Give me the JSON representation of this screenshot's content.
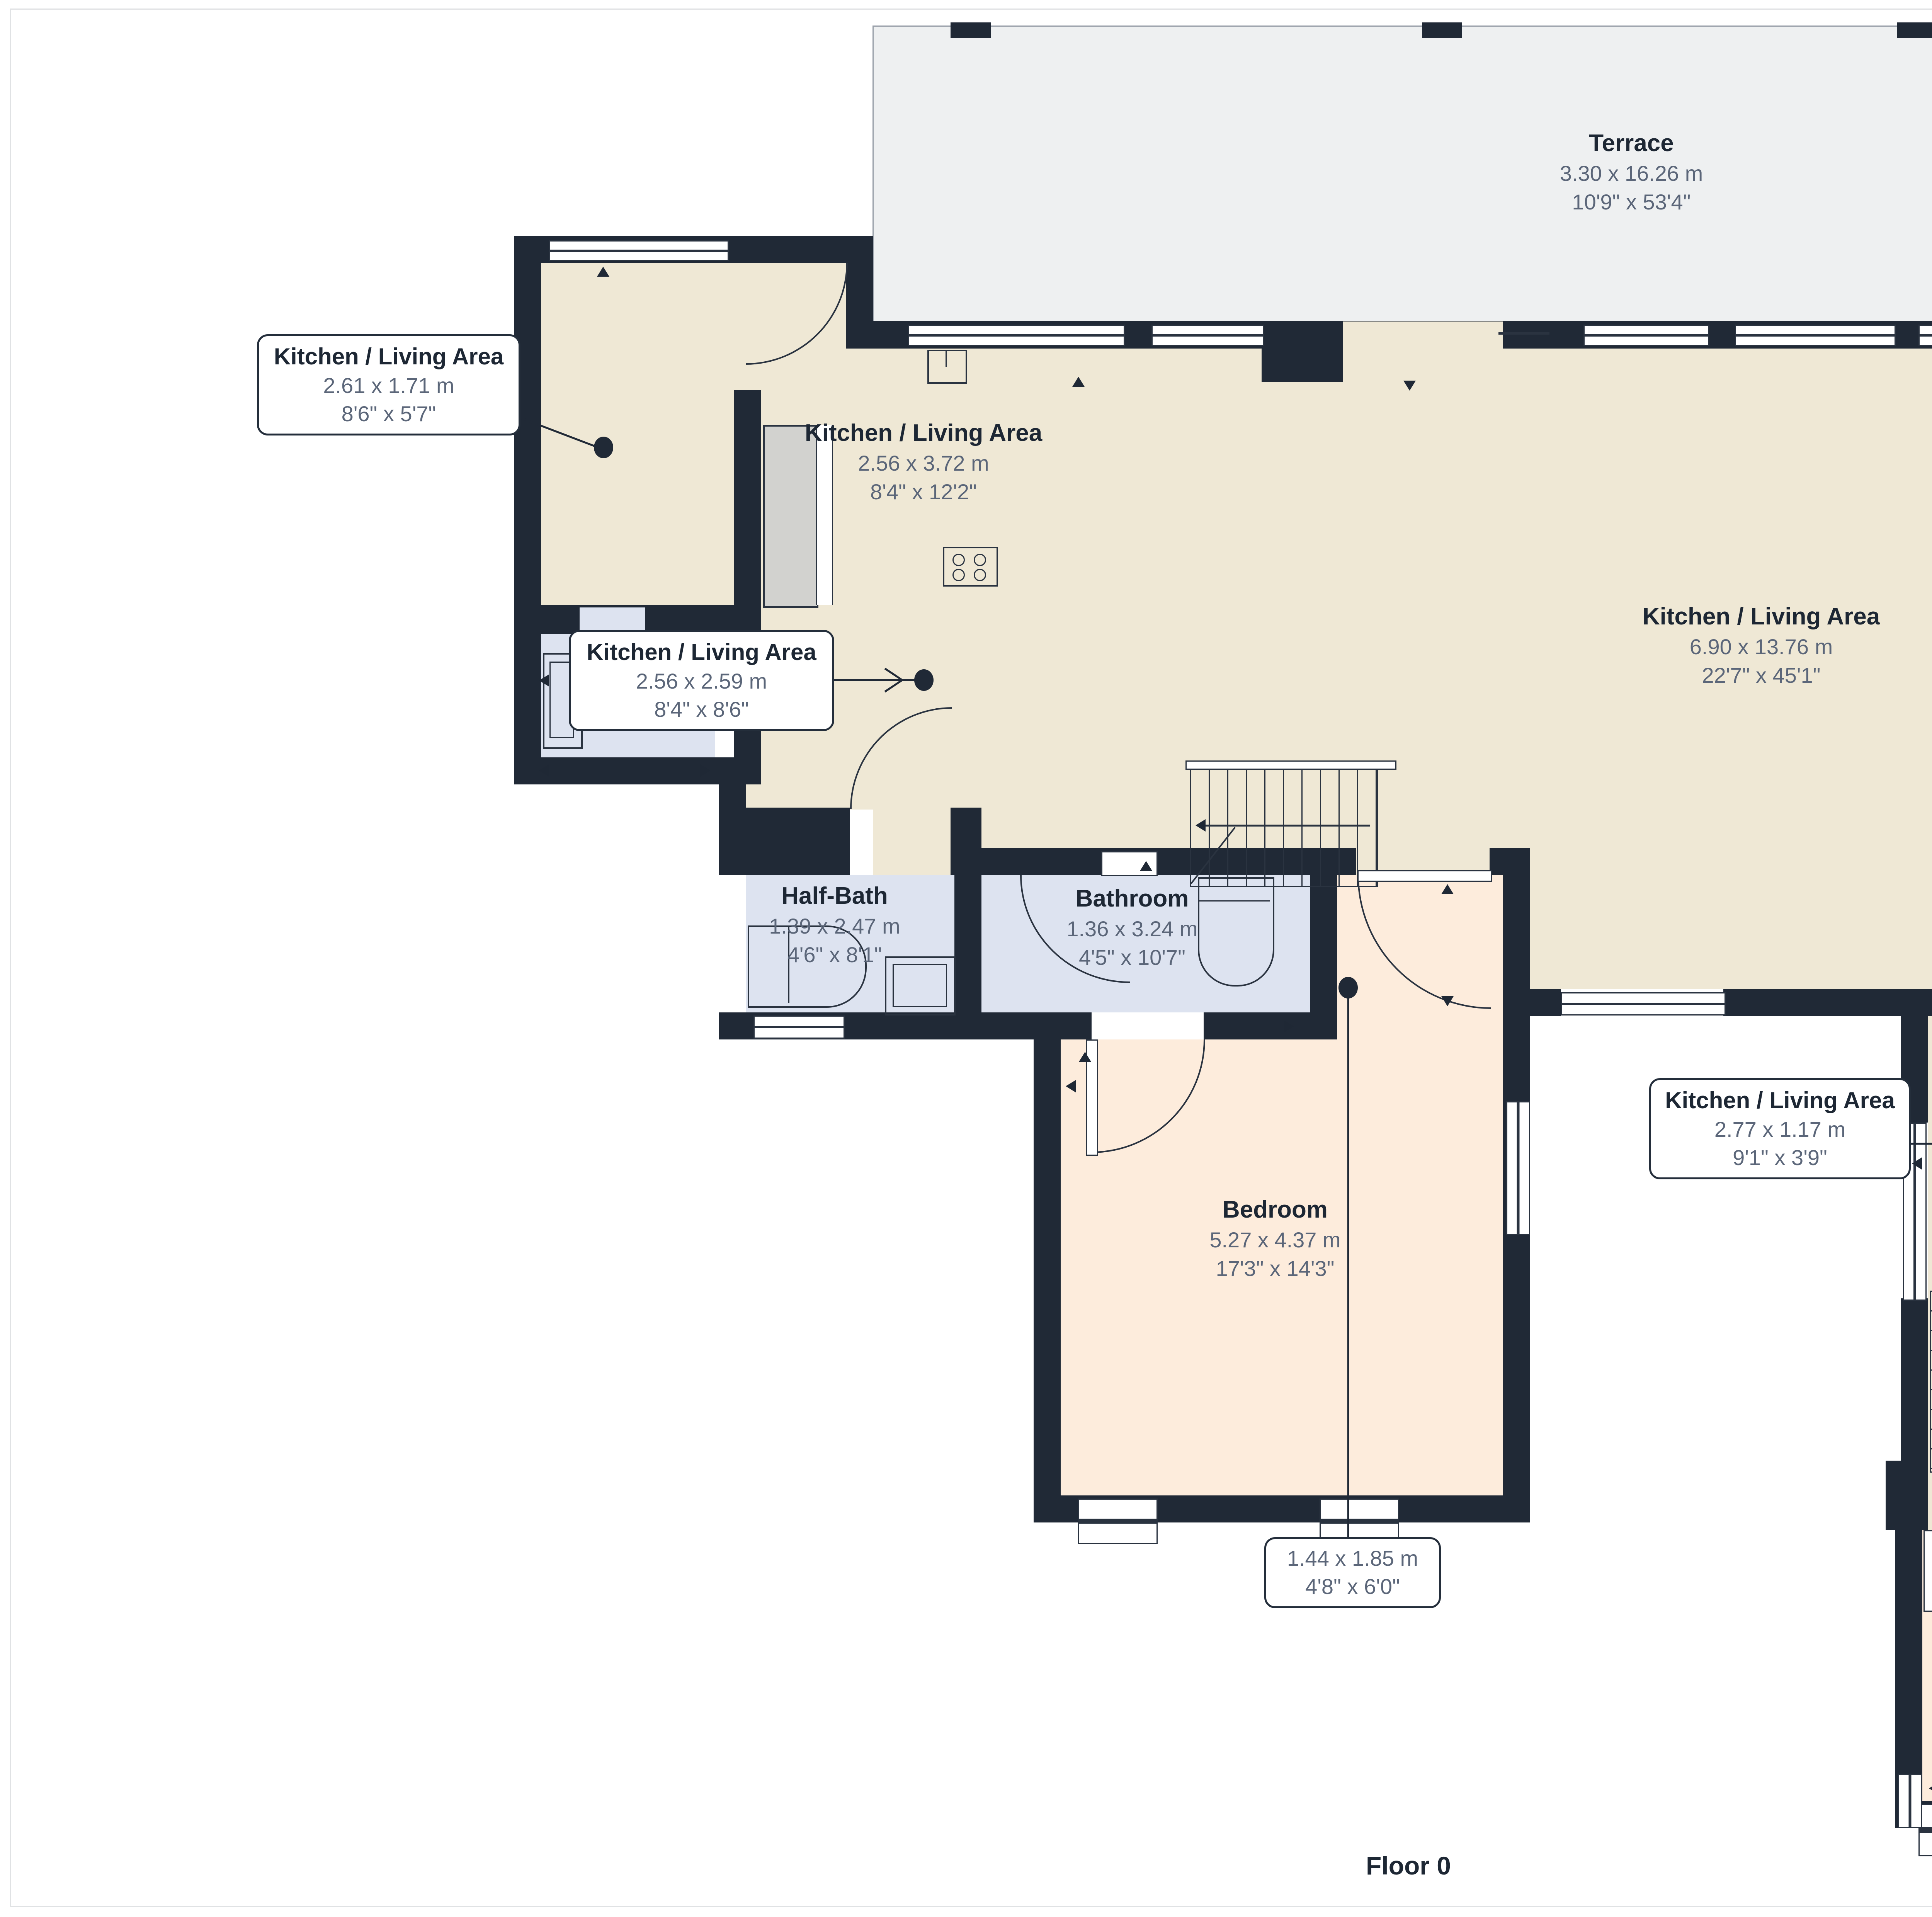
{
  "floor_label": "Floor 0",
  "rooms": {
    "terrace": {
      "name": "Terrace",
      "metric": "3.30 x 16.26 m",
      "imperial": "10'9\" x 53'4\""
    },
    "kitchen_nook": {
      "name": "Kitchen / Living Area",
      "metric": "2.56 x 3.72 m",
      "imperial": "8'4\" x 12'2\""
    },
    "kitchen_main": {
      "name": "Kitchen / Living Area",
      "metric": "6.90 x 13.76 m",
      "imperial": "22'7\" x 45'1\""
    },
    "half_bath_1": {
      "name": "Half-Bath",
      "metric": "0.91 x 2.15 m",
      "imperial": "3'0\" x 7'0\""
    },
    "half_bath_2": {
      "name": "Half-Bath",
      "metric": "1.39 x 2.47 m",
      "imperial": "4'6\" x 8'1\""
    },
    "bathroom_1": {
      "name": "Bathroom",
      "metric": "1.36 x 3.24 m",
      "imperial": "4'5\" x 10'7\""
    },
    "bathroom_2": {
      "name": "Bathroom",
      "metric": "4.50 x 3.17 m",
      "imperial": "14'9\" x 10'4\""
    },
    "bedroom_1": {
      "name": "Bedroom",
      "metric": "5.27 x 4.37 m",
      "imperial": "17'3\" x 14'3\""
    },
    "bedroom_2": {
      "name": "Bedroom",
      "metric": "4.03 x 5.87 m",
      "imperial": "13'2\" x 19'3\""
    }
  },
  "callouts": {
    "kitchen_a": {
      "name": "Kitchen / Living Area",
      "metric": "2.61 x 1.71 m",
      "imperial": "8'6\" x 5'7\""
    },
    "kitchen_b": {
      "name": "Kitchen / Living Area",
      "metric": "2.56 x 2.59 m",
      "imperial": "8'4\" x 8'6\""
    },
    "kitchen_c": {
      "name": "Kitchen / Living Area",
      "metric": "2.77 x 1.17 m",
      "imperial": "9'1\" x 3'9\""
    },
    "closet": {
      "metric": "1.44 x 1.85 m",
      "imperial": "4'8\" x 6'0\""
    }
  },
  "colors": {
    "wall": "#202936",
    "floor_beige": "#efe8d5",
    "floor_peach": "#fdecdc",
    "floor_blue": "#dde3f0",
    "terrace_gray": "#eef0f1",
    "cabinet_gray": "#d2d2cf",
    "title_text": "#1d2734",
    "dim_text": "#5b6679",
    "callout_border": "#242e3b",
    "page_border": "#e0e2e4"
  },
  "icons": {
    "door": "door-arc-icon",
    "window": "window-icon",
    "toilet": "toilet-icon",
    "sink": "sink-icon",
    "shower": "shower-icon",
    "cooktop": "cooktop-icon",
    "stairs": "stairs-icon",
    "dimension_arrow": "dimension-arrow-icon",
    "leader_dot": "leader-dot-icon"
  }
}
